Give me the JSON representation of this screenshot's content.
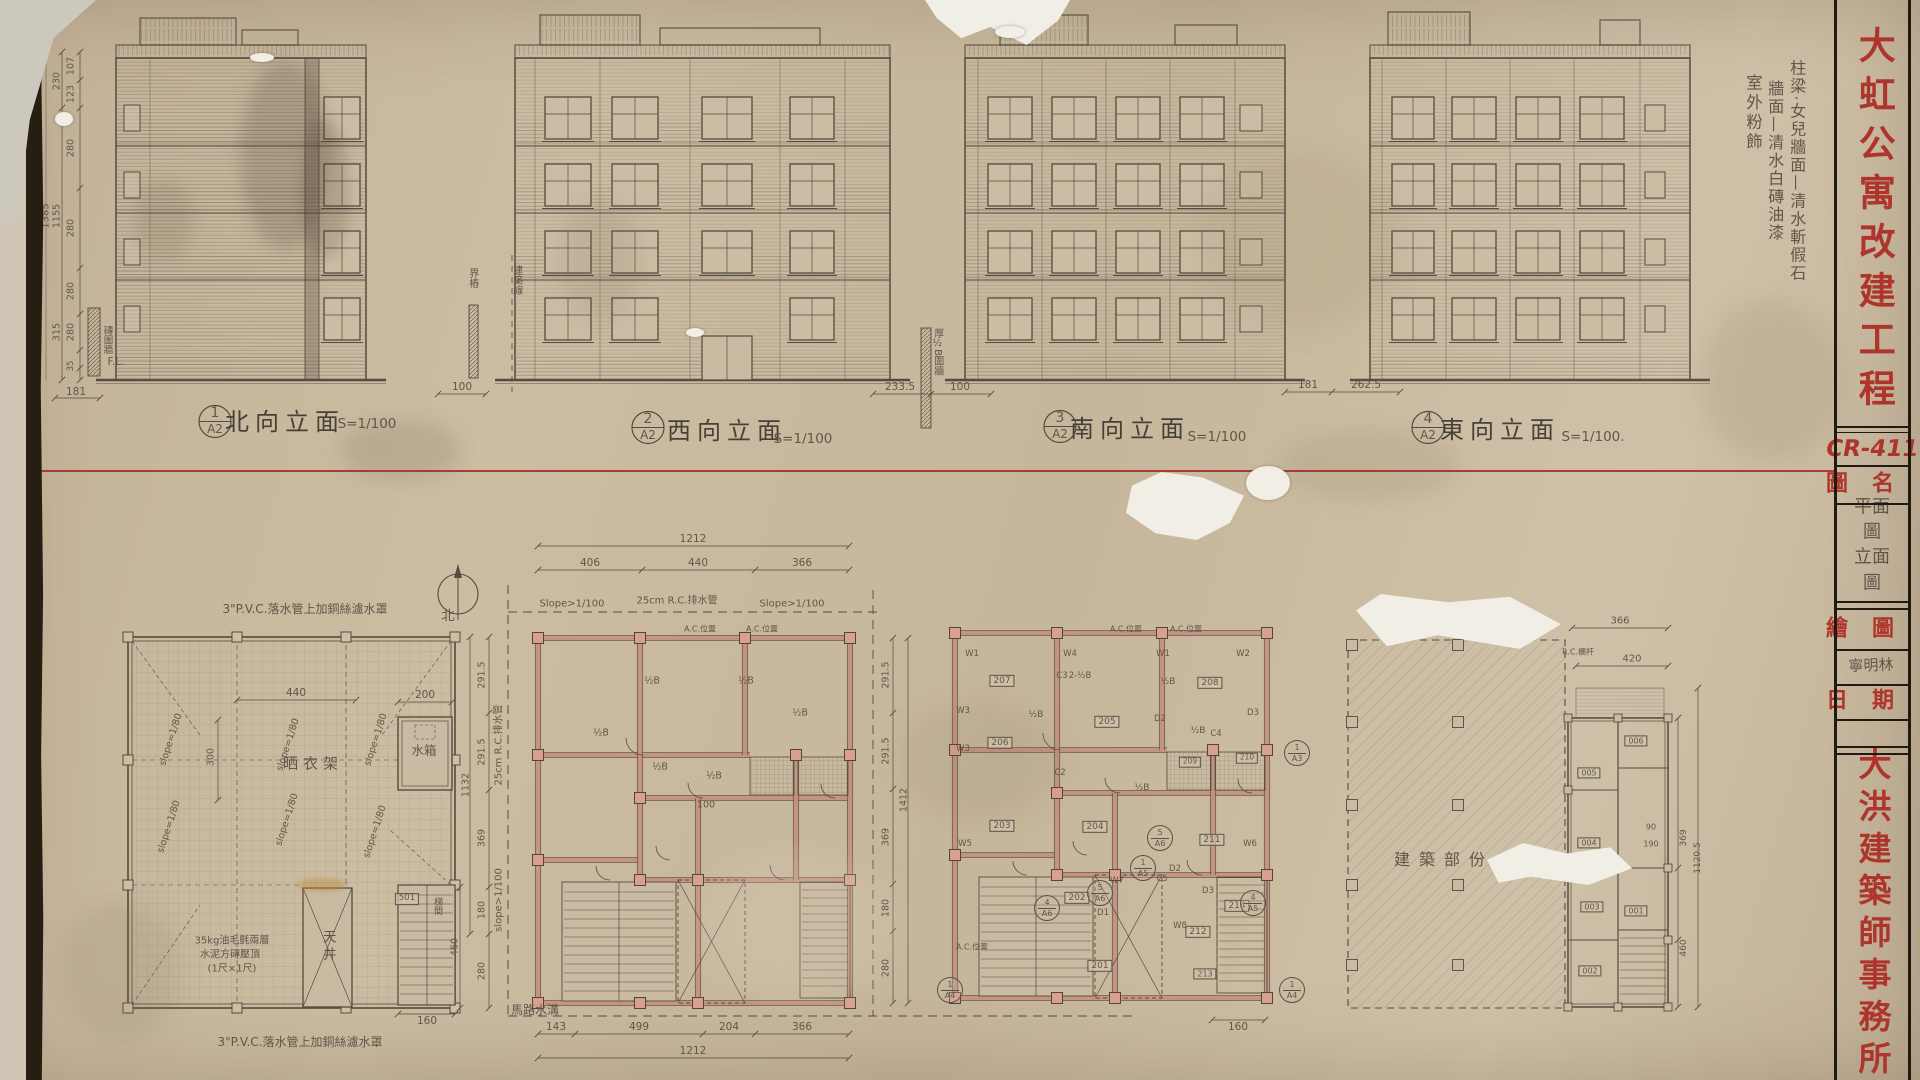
{
  "colors": {
    "paper": "#c6b79d",
    "accent_red": "#ae352b",
    "pencil": "#5f574a",
    "wall_pink": "#c4917f"
  },
  "title_block": {
    "project_title": "大虹公寓改建工程",
    "drawing_no": "CR-411",
    "drawing_name_label": "圖名",
    "drawing_name_value": "平面圖\n立面圖",
    "drawn_by_label": "繪圖",
    "drawn_by_value": "寧明林",
    "date_label": "日期",
    "office_name": "大洪建築師事務所"
  },
  "finish_notes": {
    "col1": "柱梁·女兒牆面—清水斬假石",
    "col2": "牆面—清水白磚油漆",
    "col3": "室外粉飾"
  },
  "elevations": [
    {
      "num": "1",
      "sheet": "A2",
      "name": "北向立面",
      "scale": "S=1/100"
    },
    {
      "num": "2",
      "sheet": "A2",
      "name": "西向立面",
      "scale": "S=1/100"
    },
    {
      "num": "3",
      "sheet": "A2",
      "name": "南向立面",
      "scale": "S=1/100"
    },
    {
      "num": "4",
      "sheet": "A2",
      "name": "東向立面",
      "scale": "S=1/100."
    }
  ],
  "site_labels": {
    "boundary_stake": "界樁",
    "building_line": "建築線",
    "wall_thick": "厚½B圍牆",
    "brick_wall": "磚圍牆",
    "gl": "G.L.",
    "fl": "F.L."
  },
  "elev_dims": {
    "s107": "107",
    "s123": "123",
    "s230": "230",
    "s280": "280",
    "s315": "315",
    "s35": "35",
    "t1385": "1385",
    "t1155": "1155",
    "b181": "181",
    "b100": "100",
    "g233": "233.5",
    "g100": "100",
    "g181": "181",
    "g262": "262.5"
  },
  "roof_plan": {
    "pvc_note": "3\"P.V.C.落水管上加銅絲濾水罩",
    "north": "北",
    "drying_rack": "晒衣架",
    "water_tank": "水箱",
    "light_well": "天井",
    "stair_hall": "梯間",
    "room_501": "501",
    "felt_note_1": "35kg油毛氈兩層",
    "felt_note_2": "水泥方磚壓頂",
    "felt_note_3": "(1尺×1尺)",
    "slope": "slope=1/80",
    "d440": "440",
    "d200": "200",
    "d300": "300",
    "d160": "160",
    "d291": "291.5",
    "d369": "369",
    "d180": "180",
    "d280": "280",
    "d1132": "1132",
    "d460": "460",
    "drain": "25cm R.C.排水管",
    "road_slope": "slope>1/100",
    "gutter": "馬路水溝"
  },
  "plan_b": {
    "d406": "406",
    "d440": "440",
    "d366": "366",
    "d1212": "1212",
    "d143": "143",
    "d499": "499",
    "d204": "204",
    "d291": "291.5",
    "d369": "369",
    "d180": "180",
    "d280": "280",
    "d1412": "1412",
    "slope": "Slope>1/100",
    "drain": "25cm R.C.排水管",
    "ac": "A.C.位置",
    "half_b": "½B",
    "d100": "100"
  },
  "plan_c": {
    "rooms": {
      "r201": "201",
      "r202": "202",
      "r203": "203",
      "r204": "204",
      "r205": "205",
      "r206": "206",
      "r207": "207",
      "r208": "208",
      "r209": "209",
      "r210": "210",
      "r211": "211",
      "r212": "212",
      "r213": "213",
      "r214": "214"
    },
    "tags": {
      "w1": "W1",
      "w2": "W2",
      "w3": "W3",
      "w4": "W4",
      "w5": "W5",
      "w6": "W6",
      "w7": "W7",
      "w8": "W8",
      "d1": "D1",
      "d2": "D2",
      "d3": "D3",
      "c2": "C2",
      "c3": "C3",
      "c4": "C4",
      "c5": "C5"
    },
    "refs": {
      "n1": "1",
      "n4": "4",
      "n5": "5",
      "a3": "A3",
      "a4": "A4",
      "a5": "A5",
      "a6": "A6"
    },
    "ac": "A.C.位置",
    "half_b": "½B",
    "two_half_b": "2-½B",
    "d160": "160"
  },
  "plan_d": {
    "label": "建築部份"
  },
  "plan_e": {
    "rooms": {
      "r001": "001",
      "r002": "002",
      "r003": "003",
      "r004": "004",
      "r005": "005",
      "r006": "006"
    },
    "d366": "366",
    "d420": "420",
    "rc_note": "R.C.欄杆",
    "d90": "90",
    "d190": "190",
    "d369": "369",
    "d1120": "1120.5",
    "d460": "460"
  }
}
